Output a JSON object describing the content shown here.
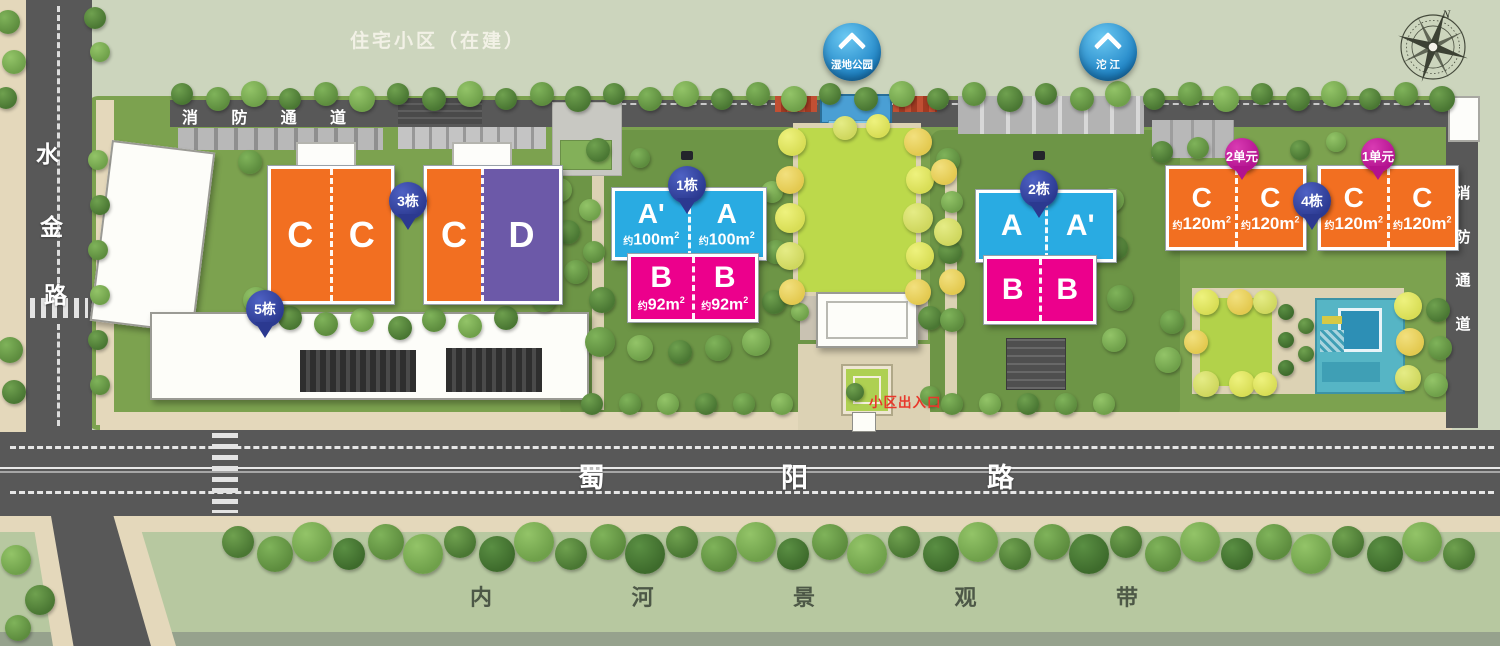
{
  "site": {
    "status_label": "住宅小区（在建）"
  },
  "roads": {
    "shuijin": {
      "name": "水金路",
      "chars": [
        "水",
        "金",
        "路"
      ]
    },
    "shuyang": {
      "name": "蜀阳路",
      "chars": [
        "蜀",
        "阳",
        "路"
      ]
    },
    "fire_top": {
      "name": "消防通道",
      "chars": [
        "消",
        "防",
        "通",
        "道"
      ]
    },
    "fire_right": {
      "name": "消防通道",
      "chars": [
        "消",
        "防",
        "通",
        "道"
      ]
    },
    "riverfront": {
      "name": "内河景观带",
      "chars": [
        "内",
        "河",
        "景",
        "观",
        "带"
      ]
    }
  },
  "badges": {
    "wetland": {
      "label": "湿地公园"
    },
    "tuojiang": {
      "label": "沱 江"
    }
  },
  "entrance": {
    "label": "小区出入口"
  },
  "compass": {
    "north": "N"
  },
  "clusters": {
    "c1": {
      "pin": "1栋",
      "upper": [
        {
          "letter": "A'",
          "area_prefix": "约",
          "area_value": "100m",
          "area_sup": "2"
        },
        {
          "letter": "A",
          "area_prefix": "约",
          "area_value": "100m",
          "area_sup": "2"
        }
      ],
      "lower": [
        {
          "letter": "B",
          "area_prefix": "约",
          "area_value": "92m",
          "area_sup": "2"
        },
        {
          "letter": "B",
          "area_prefix": "约",
          "area_value": "92m",
          "area_sup": "2"
        }
      ]
    },
    "c2": {
      "pin": "2栋",
      "upper": [
        {
          "letter": "A"
        },
        {
          "letter": "A'"
        }
      ],
      "lower": [
        {
          "letter": "B"
        },
        {
          "letter": "B"
        }
      ]
    },
    "c3": {
      "pin": "3栋",
      "units": [
        {
          "letter": "C"
        },
        {
          "letter": "C"
        },
        {
          "letter": "C"
        },
        {
          "letter": "D"
        }
      ]
    },
    "c4": {
      "pin": "4栋",
      "unit_pins": [
        {
          "label": "2单元"
        },
        {
          "label": "1单元"
        }
      ],
      "left": [
        {
          "letter": "C",
          "area_prefix": "约",
          "area_value": "120m",
          "area_sup": "2"
        },
        {
          "letter": "C",
          "area_prefix": "约",
          "area_value": "120m",
          "area_sup": "2"
        }
      ],
      "right": [
        {
          "letter": "C",
          "area_prefix": "约",
          "area_value": "120m",
          "area_sup": "2"
        },
        {
          "letter": "C",
          "area_prefix": "约",
          "area_value": "120m",
          "area_sup": "2"
        }
      ]
    },
    "c5": {
      "pin": "5栋"
    }
  },
  "colors": {
    "building_orange": "#F26F21",
    "building_purple": "#6C59A8",
    "building_blue": "#29ABE2",
    "building_pink": "#EC008C",
    "pin_blue": "#2B3990",
    "pin_magenta": "#B3128F",
    "badge_blue": "#1F84C6",
    "entrance_red": "#E8382B",
    "road_gray": "#585858"
  }
}
